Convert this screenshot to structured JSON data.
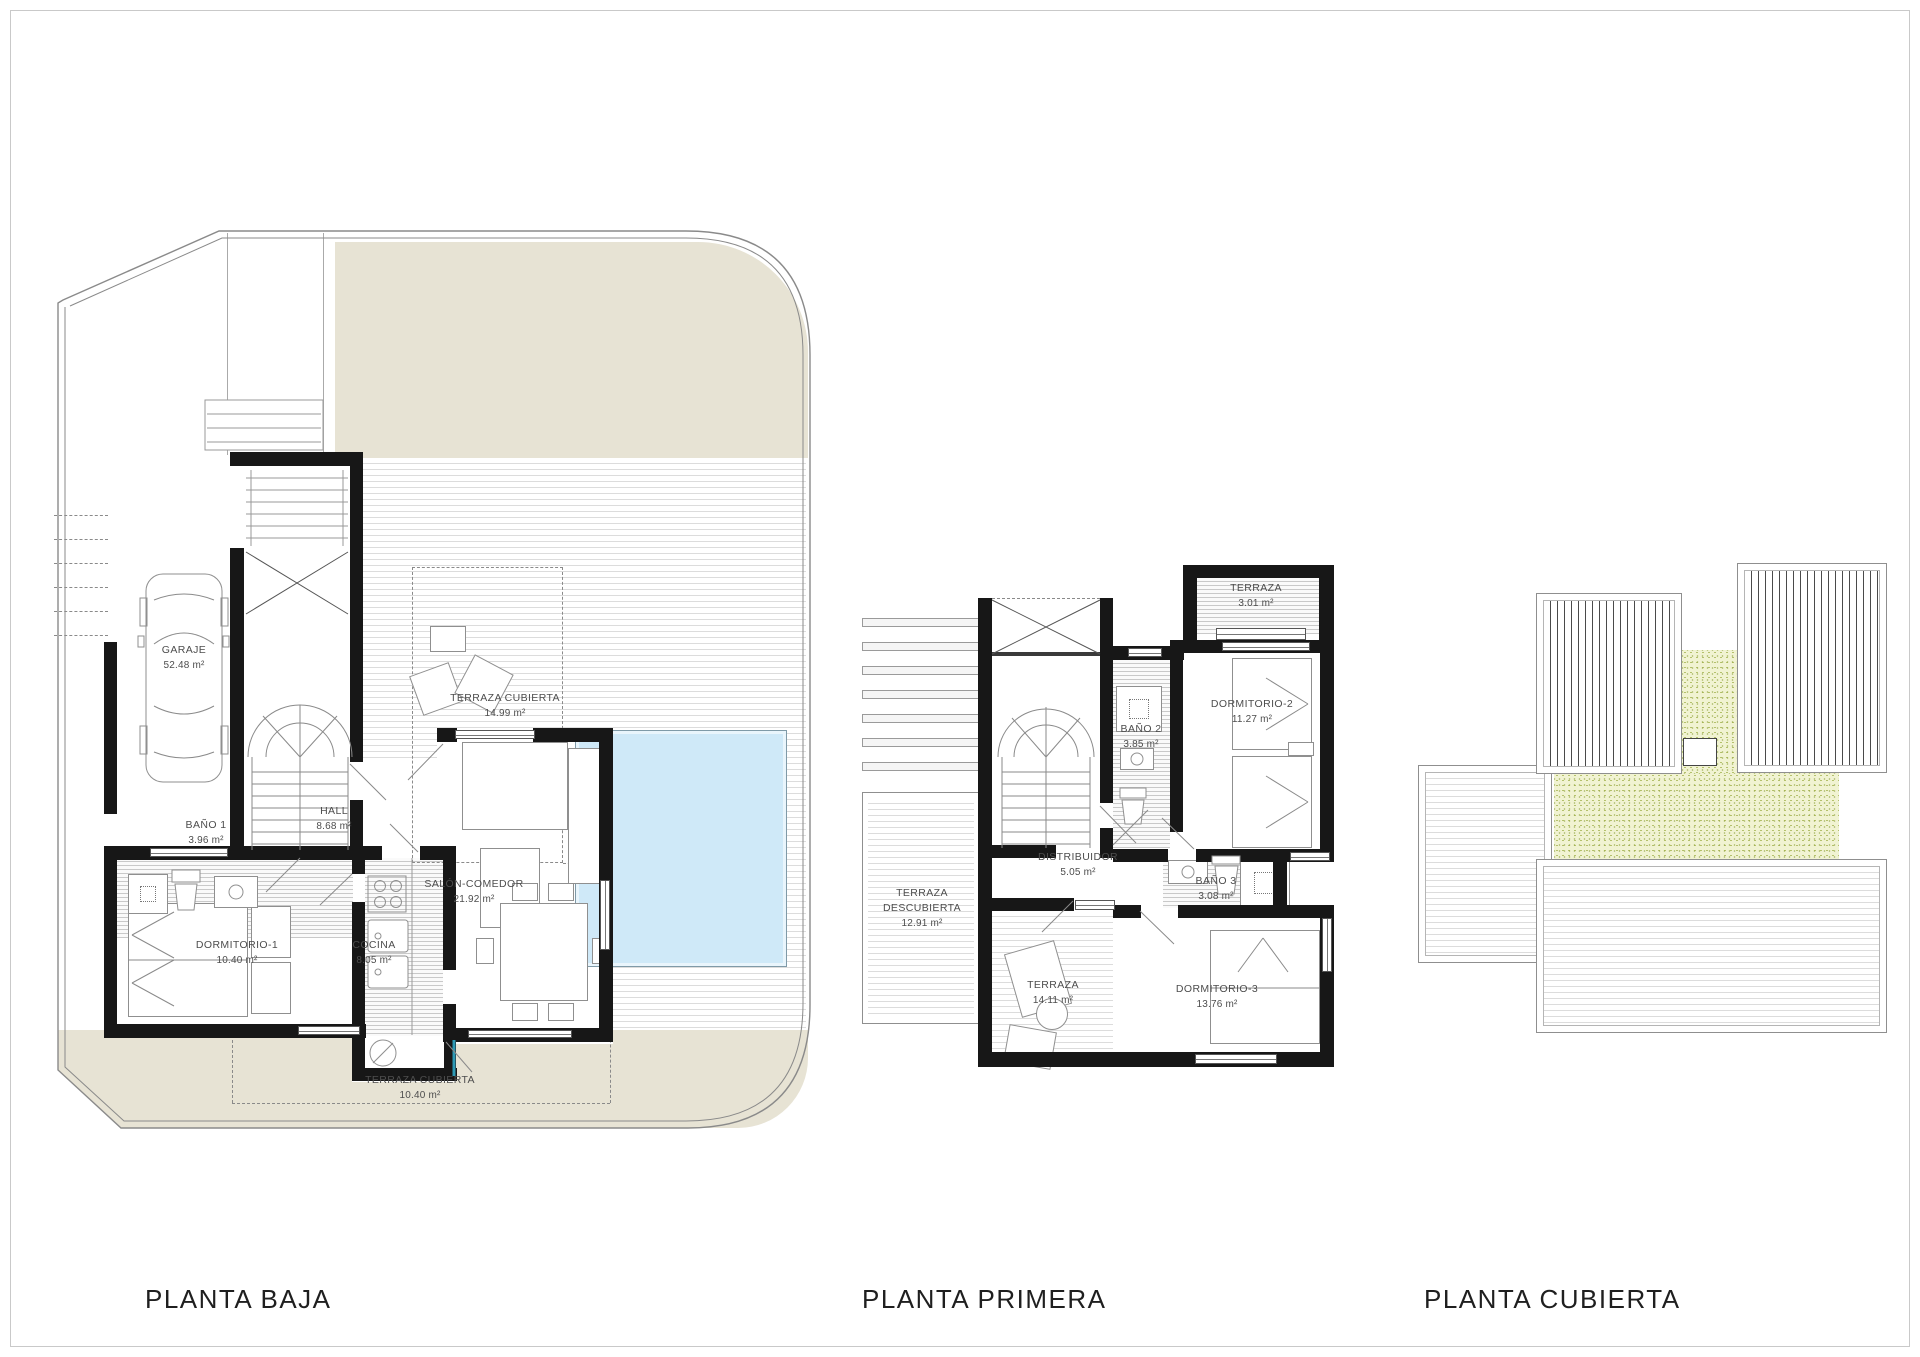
{
  "document": {
    "kind": "architectural-floor-plans",
    "sheet_background": "#ffffff"
  },
  "colors": {
    "terrain_beige": "#e7e3d4",
    "pool_blue": "#cfe9f8",
    "roof_green": "#f1f3d2",
    "wall_black": "#171717",
    "line_gray": "#8a8a8a"
  },
  "plans": [
    {
      "id": "planta-baja",
      "title": "PLANTA BAJA",
      "rooms": [
        {
          "id": "garaje",
          "name": "GARAJE",
          "area": "52.48 m²",
          "x": 184,
          "y": 643
        },
        {
          "id": "terraza-cubierta-norte",
          "name": "TERRAZA CUBIERTA",
          "area": "14.99 m²",
          "x": 505,
          "y": 691
        },
        {
          "id": "bano-1",
          "name": "BAÑO 1",
          "area": "3.96 m²",
          "x": 206,
          "y": 818
        },
        {
          "id": "hall",
          "name": "HALL",
          "area": "8.68 m²",
          "x": 334,
          "y": 804
        },
        {
          "id": "dormitorio-1",
          "name": "DORMITORIO-1",
          "area": "10.40 m²",
          "x": 237,
          "y": 938
        },
        {
          "id": "cocina",
          "name": "COCINA",
          "area": "8.05 m²",
          "x": 374,
          "y": 938
        },
        {
          "id": "salon-comedor",
          "name": "SALÓN-COMEDOR",
          "area": "21.92 m²",
          "x": 474,
          "y": 877
        },
        {
          "id": "terraza-cubierta-sur",
          "name": "TERRAZA CUBIERTA",
          "area": "10.40 m²",
          "x": 420,
          "y": 1073
        }
      ]
    },
    {
      "id": "planta-primera",
      "title": "PLANTA PRIMERA",
      "rooms": [
        {
          "id": "terraza-3",
          "name": "TERRAZA",
          "area": "3.01 m²",
          "x": 1256,
          "y": 581
        },
        {
          "id": "dormitorio-2",
          "name": "DORMITORIO-2",
          "area": "11.27 m²",
          "x": 1252,
          "y": 697
        },
        {
          "id": "bano-2",
          "name": "BAÑO 2",
          "area": "3.85 m²",
          "x": 1141,
          "y": 722
        },
        {
          "id": "distribuidor",
          "name": "DISTRIBUIDOR",
          "area": "5.05 m²",
          "x": 1078,
          "y": 850
        },
        {
          "id": "bano-3",
          "name": "BAÑO 3",
          "area": "3.08 m²",
          "x": 1216,
          "y": 874
        },
        {
          "id": "dormitorio-3",
          "name": "DORMITORIO-3",
          "area": "13.76 m²",
          "x": 1217,
          "y": 982
        },
        {
          "id": "terraza-14",
          "name": "TERRAZA",
          "area": "14.11 m²",
          "x": 1053,
          "y": 978
        },
        {
          "id": "terraza-descubierta",
          "name": "TERRAZA DESCUBIERTA",
          "area": "12.91 m²",
          "x": 922,
          "y": 886,
          "wrap": true
        }
      ]
    },
    {
      "id": "planta-cubierta",
      "title": "PLANTA CUBIERTA",
      "rooms": []
    }
  ]
}
